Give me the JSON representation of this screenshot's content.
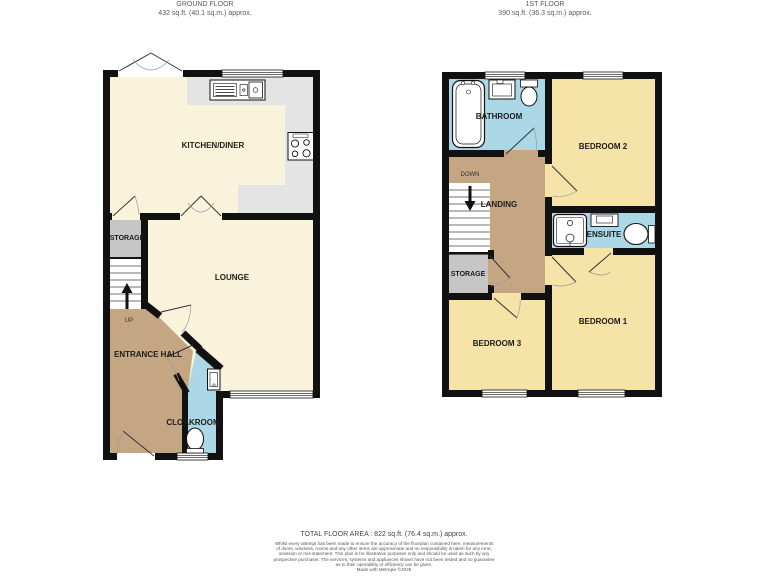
{
  "ground_floor": {
    "title": "GROUND FLOOR",
    "area": "432 sq.ft. (40.1 sq.m.) approx.",
    "rooms": {
      "kitchen": "KITCHEN/DINER",
      "lounge": "LOUNGE",
      "storage": "STORAGE",
      "entrance_hall": "ENTRANCE HALL",
      "cloakroom": "CLOAKROOM",
      "stairs_direction": "UP"
    }
  },
  "first_floor": {
    "title": "1ST FLOOR",
    "area": "390 sq.ft. (36.3 sq.m.) approx.",
    "rooms": {
      "bathroom": "BATHROOM",
      "bedroom2": "BEDROOM 2",
      "landing": "LANDING",
      "stairs_direction": "DOWN",
      "ensuite": "ENSUITE",
      "storage": "STORAGE",
      "bedroom3": "BEDROOM 3",
      "bedroom1": "BEDROOM 1"
    }
  },
  "footer": {
    "total_area": "TOTAL FLOOR AREA : 822 sq.ft. (76.4 sq.m.) approx.",
    "disclaimer_lines": [
      "Whilst every attempt has been made to ensure the accuracy of the floorplan contained here, measurements",
      "of doors, windows, rooms and any other items are approximate and no responsibility is taken for any error,",
      "omission or mis-statement. This plan is for illustrative purposes only and should be used as such by any",
      "prospective purchaser. The services, systems and appliances shown have not been tested and no guarantee",
      "as to their operability or efficiency can be given.",
      "Made with Metropix ©2025"
    ]
  },
  "colors": {
    "wall": "#111111",
    "kitchen_lounge_floor": "#f9f3dc",
    "bedroom_floor": "#f6e3a7",
    "hall_landing_floor": "#c5a683",
    "wet_room_floor": "#abd7e6",
    "storage_floor": "#c6c6c6",
    "counter": "#e4e4e4"
  }
}
